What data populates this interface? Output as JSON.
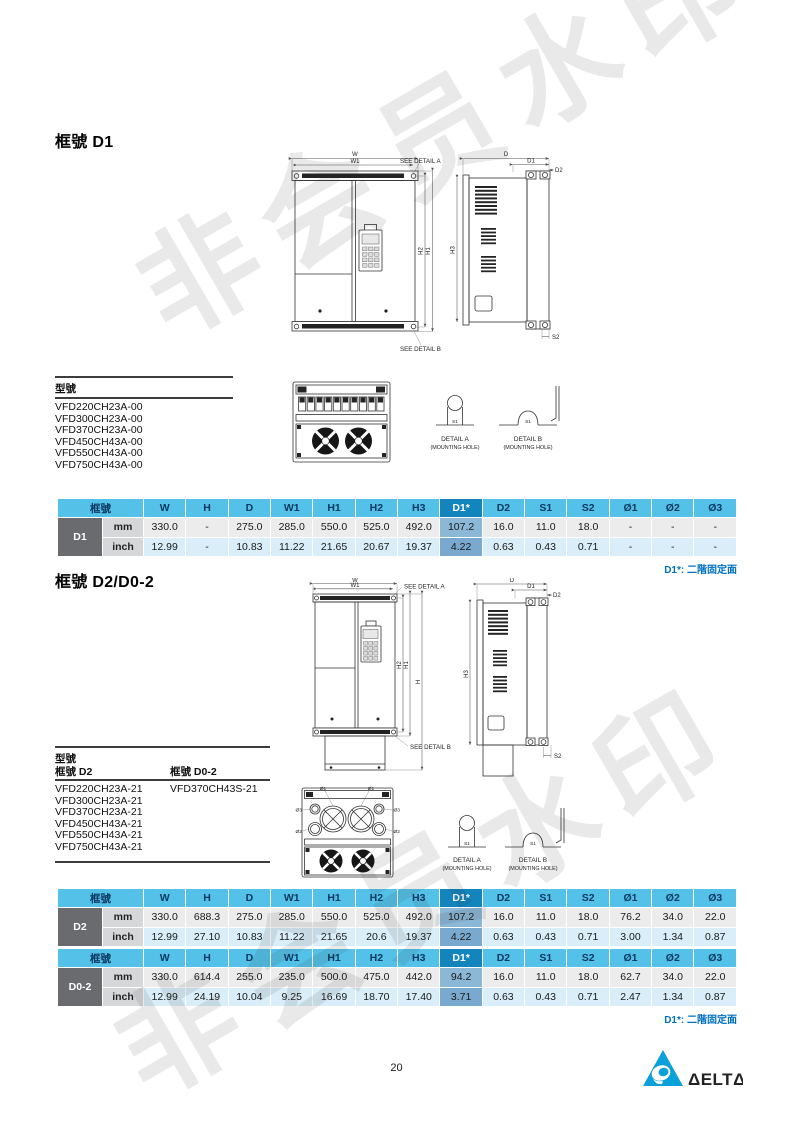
{
  "watermark": {
    "text": "非会员水印"
  },
  "drawing_labels": {
    "w": "W",
    "w1": "W1",
    "h": "H",
    "h1": "H1",
    "h2": "H2",
    "h3": "H3",
    "d": "D",
    "d1": "D1",
    "d2": "D2",
    "s1": "S1",
    "s2": "S2",
    "see_detail_a": "SEE DETAIL A",
    "see_detail_b": "SEE DETAIL B",
    "detail_a": "DETAIL A",
    "detail_b": "DETAIL B",
    "mounting_hole": "(MOUNTING HOLE)",
    "dia1": "Ø1",
    "dia2": "Ø2",
    "dia3": "Ø3"
  },
  "section1": {
    "title": "框號 D1",
    "models_header": "型號",
    "models": [
      "VFD220CH23A-00",
      "VFD300CH23A-00",
      "VFD370CH23A-00",
      "VFD450CH43A-00",
      "VFD550CH43A-00",
      "VFD750CH43A-00"
    ],
    "note": "D1*: 二階固定面",
    "table": {
      "frame_header": "框號",
      "columns": [
        "W",
        "H",
        "D",
        "W1",
        "H1",
        "H2",
        "H3",
        "D1*",
        "D2",
        "S1",
        "S2",
        "Ø1",
        "Ø2",
        "Ø3"
      ],
      "highlight_column": "D1*",
      "frame": "D1",
      "rows": [
        {
          "unit": "mm",
          "values": [
            "330.0",
            "-",
            "275.0",
            "285.0",
            "550.0",
            "525.0",
            "492.0",
            "107.2",
            "16.0",
            "11.0",
            "18.0",
            "-",
            "-",
            "-"
          ]
        },
        {
          "unit": "inch",
          "values": [
            "12.99",
            "-",
            "10.83",
            "11.22",
            "21.65",
            "20.67",
            "19.37",
            "4.22",
            "0.63",
            "0.43",
            "0.71",
            "-",
            "-",
            "-"
          ]
        }
      ]
    }
  },
  "section2": {
    "title": "框號 D2/D0-2",
    "models_header": "型號",
    "models_col1_header": "框號 D2",
    "models_col2_header": "框號 D0-2",
    "models_col1": [
      "VFD220CH23A-21",
      "VFD300CH23A-21",
      "VFD370CH23A-21",
      "VFD450CH43A-21",
      "VFD550CH43A-21",
      "VFD750CH43A-21"
    ],
    "models_col2": [
      "VFD370CH43S-21"
    ],
    "note": "D1*: 二階固定面",
    "tables": [
      {
        "frame_header": "框號",
        "columns": [
          "W",
          "H",
          "D",
          "W1",
          "H1",
          "H2",
          "H3",
          "D1*",
          "D2",
          "S1",
          "S2",
          "Ø1",
          "Ø2",
          "Ø3"
        ],
        "highlight_column": "D1*",
        "frame": "D2",
        "rows": [
          {
            "unit": "mm",
            "values": [
              "330.0",
              "688.3",
              "275.0",
              "285.0",
              "550.0",
              "525.0",
              "492.0",
              "107.2",
              "16.0",
              "11.0",
              "18.0",
              "76.2",
              "34.0",
              "22.0"
            ]
          },
          {
            "unit": "inch",
            "values": [
              "12.99",
              "27.10",
              "10.83",
              "11.22",
              "21.65",
              "20.6",
              "19.37",
              "4.22",
              "0.63",
              "0.43",
              "0.71",
              "3.00",
              "1.34",
              "0.87"
            ]
          }
        ]
      },
      {
        "frame_header": "框號",
        "columns": [
          "W",
          "H",
          "D",
          "W1",
          "H1",
          "H2",
          "H3",
          "D1*",
          "D2",
          "S1",
          "S2",
          "Ø1",
          "Ø2",
          "Ø3"
        ],
        "highlight_column": "D1*",
        "frame": "D0-2",
        "rows": [
          {
            "unit": "mm",
            "values": [
              "330.0",
              "614.4",
              "255.0",
              "235.0",
              "500.0",
              "475.0",
              "442.0",
              "94.2",
              "16.0",
              "11.0",
              "18.0",
              "62.7",
              "34.0",
              "22.0"
            ]
          },
          {
            "unit": "inch",
            "values": [
              "12.99",
              "24.19",
              "10.04",
              "9.25",
              "16.69",
              "18.70",
              "17.40",
              "3.71",
              "0.63",
              "0.43",
              "0.71",
              "2.47",
              "1.34",
              "0.87"
            ]
          }
        ]
      }
    ]
  },
  "footer": {
    "page_number": "20",
    "logo_text": "ΔELTΔ"
  }
}
